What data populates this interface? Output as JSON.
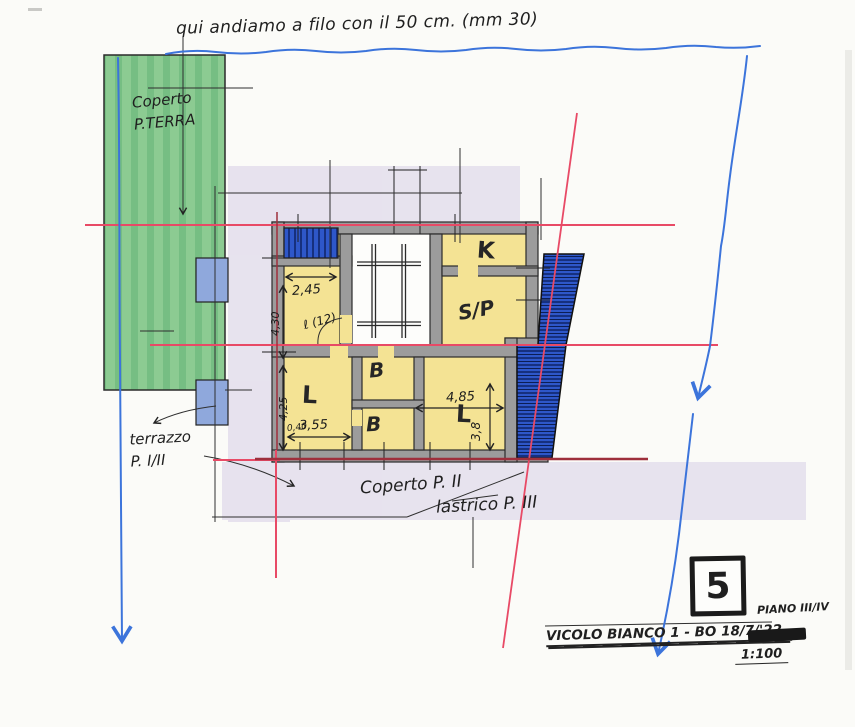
{
  "colors": {
    "paper": "#FBFBF8",
    "green": "#8CCB92",
    "green_stripe": "#72BC80",
    "yellow": "#F4E394",
    "lavender": "#D7CFE6",
    "wall_gray": "#9C9C9C",
    "blue_hatch": "#2E57C9",
    "blue_hatch_dark": "#16307F",
    "blue_patch": "#8FA8DC",
    "ink_blue": "#3C74DB",
    "red_line": "#E84A66",
    "dark_red": "#9E2F3C",
    "ink_black": "#222222"
  },
  "annotations": {
    "top_note": "qui andiamo a filo con il 50 cm. (mm 30)",
    "coperto_terra_line1": "Coperto",
    "coperto_terra_line2": "P.TERRA",
    "terrazzo_line1": "terrazzo",
    "terrazzo_line2": "P. I/II",
    "coperto_p2": "Coperto P. II",
    "lastrico_p3": "lastrico P. III"
  },
  "plan": {
    "rooms": [
      {
        "id": "kitchen",
        "label": "K"
      },
      {
        "id": "soggiorno-pranzo",
        "label": "S/P"
      },
      {
        "id": "letto-1",
        "label": "L"
      },
      {
        "id": "bagno-1",
        "label": "B"
      },
      {
        "id": "bagno-2",
        "label": "B"
      },
      {
        "id": "letto-2",
        "label": "L"
      }
    ],
    "dimensions": {
      "d245": "2,45",
      "d430": "4,30",
      "door": "ℓ (12)",
      "d040": "0,40",
      "d425": "4,25",
      "d355": "3,55",
      "d485": "4,85",
      "d38": "3,8"
    }
  },
  "title_block": {
    "sheet_number": "5",
    "piano": "PIANO III/IV",
    "address": "VICOLO BIANCO 1 - BO 18/7/'22 -",
    "scale": "1:100"
  }
}
